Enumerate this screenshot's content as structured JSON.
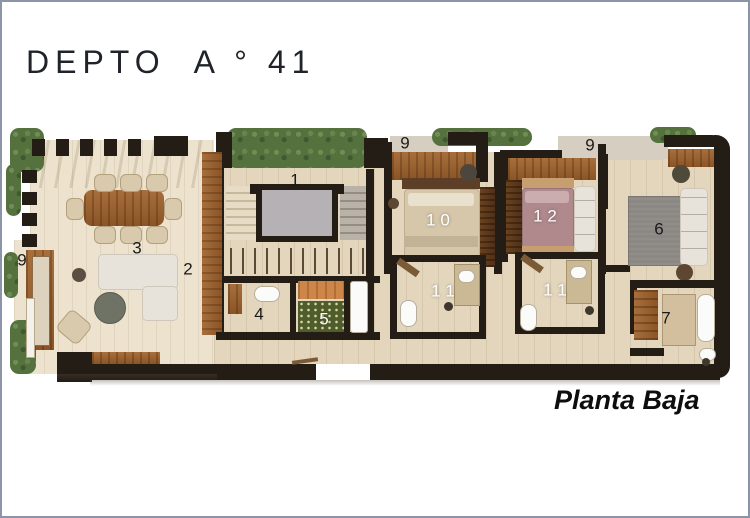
{
  "title": "DEPTO  A ° 41",
  "caption": "Planta Baja",
  "colors": {
    "frame_border": "#8b95a7",
    "wall": "#241d16",
    "floor_main": "#e3d6bd",
    "floor_terrace": "#ece2ce",
    "wood": "#9c6434",
    "greenery": "#55713e",
    "elevator_cab": "#b6b1b5",
    "bed_primary": "#d6c7ab",
    "bed_secondary": "#b0898d",
    "rug": "#8b8884",
    "pantry_mosaic": "#4f5c2c",
    "label_dark": "#1a1a1a",
    "label_light": "#ffffff"
  },
  "room_labels": [
    {
      "label": "1",
      "x": 293,
      "y": 178,
      "color": "#1a1a1a"
    },
    {
      "label": "2",
      "x": 186,
      "y": 267,
      "color": "#1a1a1a"
    },
    {
      "label": "3",
      "x": 135,
      "y": 246,
      "color": "#1a1a1a"
    },
    {
      "label": "4",
      "x": 257,
      "y": 312,
      "color": "#1a1a1a"
    },
    {
      "label": "5",
      "x": 322,
      "y": 317,
      "color": "#ffffff"
    },
    {
      "label": "6",
      "x": 657,
      "y": 227,
      "color": "#1a1a1a"
    },
    {
      "label": "7",
      "x": 664,
      "y": 316,
      "color": "#1a1a1a"
    },
    {
      "label": "9",
      "x": 20,
      "y": 258,
      "color": "#1a1a1a"
    },
    {
      "label": "9",
      "x": 403,
      "y": 141,
      "color": "#1a1a1a"
    },
    {
      "label": "9",
      "x": 588,
      "y": 143,
      "color": "#1a1a1a"
    },
    {
      "label": "1 0",
      "x": 436,
      "y": 218,
      "color": "#ffffff"
    },
    {
      "label": "1 1",
      "x": 441,
      "y": 289,
      "color": "#ffffff"
    },
    {
      "label": "1 2",
      "x": 543,
      "y": 214,
      "color": "#ffffff"
    },
    {
      "label": "1 1",
      "x": 553,
      "y": 288,
      "color": "#ffffff"
    }
  ]
}
